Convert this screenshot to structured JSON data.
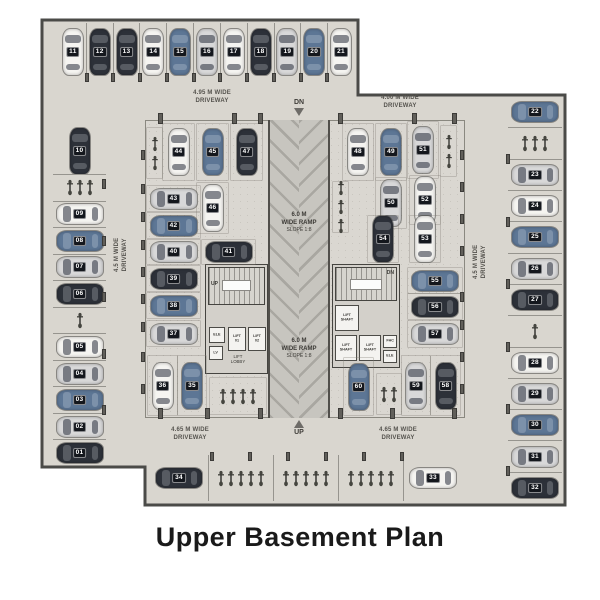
{
  "title": "Upper Basement Plan",
  "labels": {
    "dn": "DN",
    "up": "UP",
    "stair_up": "UP",
    "stair_dn": "DN",
    "driveway_top_left": [
      "4.95 M WIDE",
      "DRIVEWAY"
    ],
    "driveway_top_right": [
      "4.00 M WIDE",
      "DRIVEWAY"
    ],
    "driveway_left": [
      "4.5 M WIDE",
      "DRIVEWAY"
    ],
    "driveway_right": [
      "4.5 M WIDE",
      "DRIVEWAY"
    ],
    "driveway_bottom_left": [
      "4.65 M WIDE",
      "DRIVEWAY"
    ],
    "driveway_bottom_right": [
      "4.65 M WIDE",
      "DRIVEWAY"
    ],
    "ramp_upper": [
      "6.0 M",
      "WIDE RAMP",
      "SLOPE 1:8"
    ],
    "ramp_lower": [
      "6.0 M",
      "WIDE RAMP",
      "SLOPE 1:8"
    ]
  },
  "cores": {
    "left": {
      "rooms": [
        {
          "label": "ELE"
        },
        {
          "label": "LV"
        },
        {
          "label": "LIFT 01"
        },
        {
          "label": "LIFT 02"
        }
      ],
      "lobby": "LIFT\nLOBBY"
    },
    "right": {
      "rooms": [
        {
          "label": "LIFT\nSHAFT"
        },
        {
          "label": "LIFT\nSHAFT"
        },
        {
          "label": "LIFT\nSHAFT"
        },
        {
          "label": "FHC"
        },
        {
          "label": "ELE"
        }
      ]
    }
  },
  "car_colors": {
    "white": "#f5f4f1",
    "silver": "#d8d8d9",
    "blue": "#5d7695",
    "dark": "#2d3139"
  },
  "stall_groups": {
    "top_row": [
      {
        "n": "11",
        "c": "white"
      },
      {
        "n": "12",
        "c": "dark"
      },
      {
        "n": "13",
        "c": "dark"
      },
      {
        "n": "14",
        "c": "white"
      },
      {
        "n": "15",
        "c": "blue"
      },
      {
        "n": "16",
        "c": "silver"
      },
      {
        "n": "17",
        "c": "white"
      },
      {
        "n": "18",
        "c": "dark"
      },
      {
        "n": "19",
        "c": "silver"
      },
      {
        "n": "20",
        "c": "blue"
      },
      {
        "n": "21",
        "c": "white"
      }
    ],
    "left_col": [
      {
        "n": "10",
        "c": "dark",
        "o": "v"
      },
      {
        "type": "bikes",
        "count": 3
      },
      {
        "n": "09",
        "c": "white"
      },
      {
        "n": "08",
        "c": "blue"
      },
      {
        "n": "07",
        "c": "silver"
      },
      {
        "n": "06",
        "c": "dark"
      },
      {
        "type": "bikes",
        "count": 1
      },
      {
        "n": "05",
        "c": "white"
      },
      {
        "n": "04",
        "c": "silver"
      },
      {
        "n": "03",
        "c": "blue"
      },
      {
        "n": "02",
        "c": "silver"
      },
      {
        "n": "01",
        "c": "dark"
      }
    ],
    "right_col": [
      {
        "n": "22",
        "c": "blue"
      },
      {
        "type": "bikes",
        "count": 3
      },
      {
        "n": "23",
        "c": "silver"
      },
      {
        "n": "24",
        "c": "white"
      },
      {
        "n": "25",
        "c": "blue"
      },
      {
        "n": "26",
        "c": "silver"
      },
      {
        "n": "27",
        "c": "dark"
      },
      {
        "type": "bikes",
        "count": 1
      },
      {
        "n": "28",
        "c": "white"
      },
      {
        "n": "29",
        "c": "silver"
      },
      {
        "n": "30",
        "c": "blue"
      },
      {
        "n": "31",
        "c": "silver"
      },
      {
        "n": "32",
        "c": "dark"
      }
    ],
    "bottom_row": [
      {
        "n": "34",
        "c": "dark"
      },
      {
        "type": "bikes",
        "count": 5
      },
      {
        "type": "bikes",
        "count": 5
      },
      {
        "type": "bikes",
        "count": 5
      },
      {
        "n": "33",
        "c": "white"
      }
    ],
    "inner_left": [
      {
        "type": "bikes",
        "count": 2,
        "id": "il_b1"
      },
      {
        "n": "44",
        "c": "white"
      },
      {
        "n": "45",
        "c": "blue"
      },
      {
        "n": "47",
        "c": "dark"
      },
      {
        "n": "46",
        "c": "white"
      },
      {
        "n": "43",
        "c": "silver"
      },
      {
        "n": "42",
        "c": "blue"
      },
      {
        "n": "40",
        "c": "silver"
      },
      {
        "n": "41",
        "c": "dark"
      },
      {
        "n": "39",
        "c": "dark"
      },
      {
        "n": "38",
        "c": "blue"
      },
      {
        "n": "37",
        "c": "silver"
      },
      {
        "n": "36",
        "c": "white"
      },
      {
        "n": "35",
        "c": "blue"
      },
      {
        "type": "bikes",
        "count": 4,
        "id": "il_b2"
      }
    ],
    "inner_right": [
      {
        "n": "48",
        "c": "white"
      },
      {
        "n": "49",
        "c": "blue"
      },
      {
        "n": "51",
        "c": "silver"
      },
      {
        "type": "bikes",
        "count": 2,
        "id": "ir_b1"
      },
      {
        "type": "bikes",
        "count": 3,
        "id": "ir_b2"
      },
      {
        "n": "50",
        "c": "silver"
      },
      {
        "n": "52",
        "c": "white"
      },
      {
        "n": "54",
        "c": "dark"
      },
      {
        "n": "53",
        "c": "white"
      },
      {
        "n": "55",
        "c": "blue"
      },
      {
        "n": "56",
        "c": "dark"
      },
      {
        "n": "57",
        "c": "silver"
      },
      {
        "n": "60",
        "c": "blue"
      },
      {
        "type": "bikes",
        "count": 2,
        "id": "ir_b3"
      },
      {
        "n": "59",
        "c": "silver"
      },
      {
        "n": "58",
        "c": "dark"
      }
    ]
  }
}
